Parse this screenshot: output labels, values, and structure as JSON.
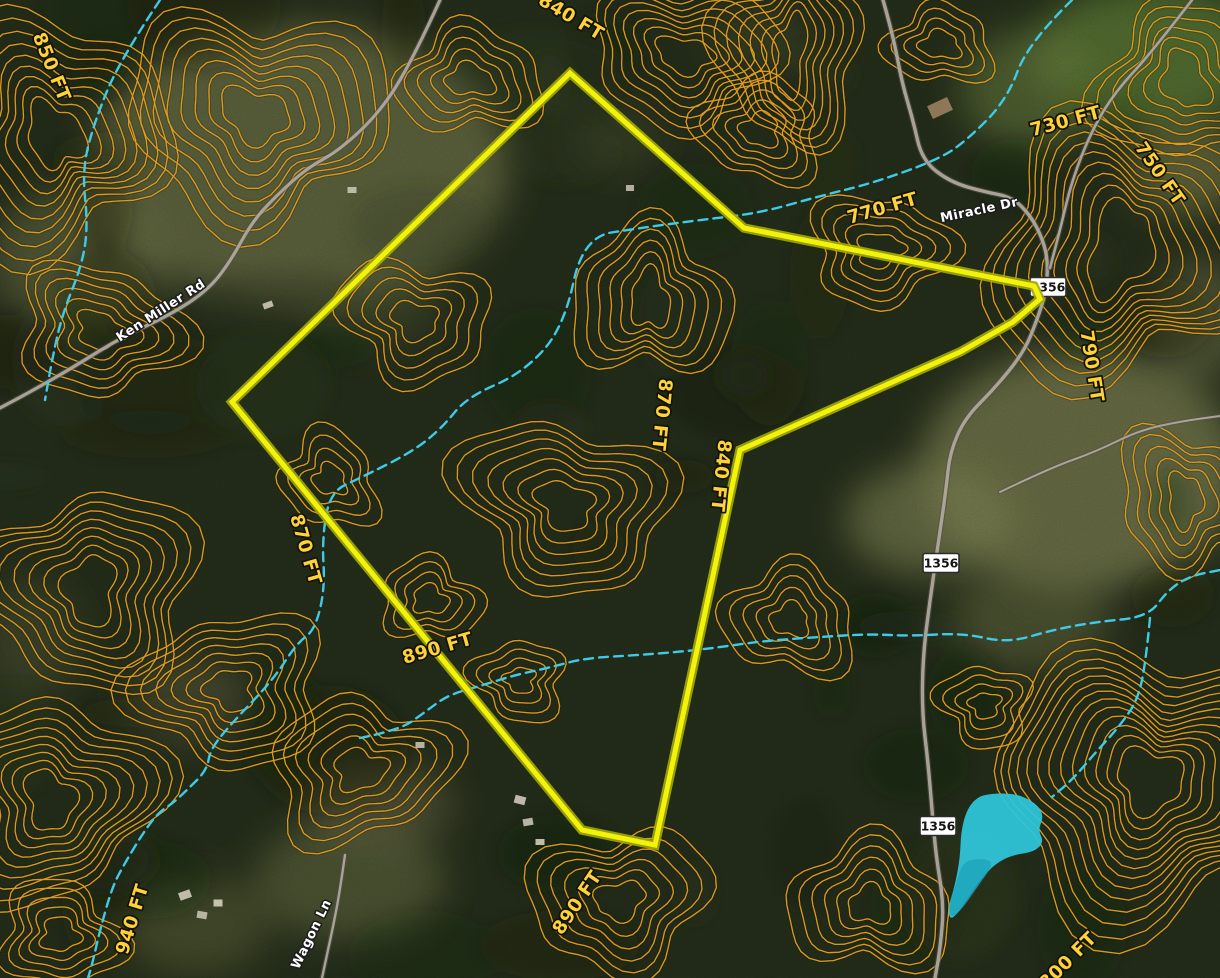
{
  "map": {
    "colors": {
      "forest_base": "#27311c",
      "contour": "#e29e1c",
      "boundary_core": "#f2f20a",
      "boundary_casing": "#a3a80a",
      "stream": "#3fcbe8",
      "pond_fill": "#2ec4d8",
      "pond_shade": "#1ea4bd",
      "road_core": "#b3ada0",
      "road_casing": "#55504a",
      "elevation_text": "#ffd235",
      "road_text": "#ffffff",
      "shield_bg": "#ffffff",
      "shield_text": "#151515"
    },
    "boundary": {
      "points": [
        [
          570,
          73
        ],
        [
          744,
          228
        ],
        [
          1034,
          286
        ],
        [
          1040,
          299
        ],
        [
          1013,
          322
        ],
        [
          960,
          352
        ],
        [
          740,
          450
        ],
        [
          655,
          845
        ],
        [
          582,
          830
        ],
        [
          232,
          402
        ]
      ]
    },
    "elevation_labels": [
      {
        "text": "850 FT",
        "x": 46,
        "y": 69,
        "rot": 68
      },
      {
        "text": "840 FT",
        "x": 568,
        "y": 22,
        "rot": 31
      },
      {
        "text": "730 FT",
        "x": 1067,
        "y": 127,
        "rot": -15
      },
      {
        "text": "750 FT",
        "x": 1155,
        "y": 177,
        "rot": 55
      },
      {
        "text": "770 FT",
        "x": 884,
        "y": 214,
        "rot": -16
      },
      {
        "text": "790 FT",
        "x": 1086,
        "y": 367,
        "rot": 81
      },
      {
        "text": "870 FT",
        "x": 656,
        "y": 414,
        "rot": 96
      },
      {
        "text": "840 FT",
        "x": 715,
        "y": 475,
        "rot": 96
      },
      {
        "text": "870 FT",
        "x": 300,
        "y": 551,
        "rot": 74
      },
      {
        "text": "890 FT",
        "x": 439,
        "y": 654,
        "rot": -16
      },
      {
        "text": "890 FT",
        "x": 582,
        "y": 906,
        "rot": -56
      },
      {
        "text": "940 FT",
        "x": 138,
        "y": 921,
        "rot": -73
      },
      {
        "text": "800 FT",
        "x": 1072,
        "y": 965,
        "rot": -45
      }
    ],
    "road_labels": [
      {
        "text": "Ken Miller Rd",
        "x": 163,
        "y": 314,
        "rot": -33
      },
      {
        "text": "Miracle Dr",
        "x": 980,
        "y": 214,
        "rot": -12
      },
      {
        "text": "Wagon Ln",
        "x": 315,
        "y": 936,
        "rot": -64
      }
    ],
    "route_shields": [
      {
        "text": "1356",
        "x": 1048,
        "y": 287
      },
      {
        "text": "1356",
        "x": 941,
        "y": 563
      },
      {
        "text": "1356",
        "x": 938,
        "y": 826
      }
    ],
    "roads": [
      {
        "id": "ken-miller-rd",
        "w": 3.2,
        "points": [
          [
            440,
            0
          ],
          [
            415,
            55
          ],
          [
            382,
            110
          ],
          [
            340,
            150
          ],
          [
            307,
            168
          ],
          [
            276,
            196
          ],
          [
            252,
            222
          ],
          [
            230,
            262
          ],
          [
            208,
            290
          ],
          [
            170,
            315
          ],
          [
            120,
            338
          ],
          [
            72,
            368
          ],
          [
            30,
            392
          ],
          [
            0,
            408
          ]
        ]
      },
      {
        "id": "miracle-dr-1356",
        "w": 3.4,
        "points": [
          [
            883,
            0
          ],
          [
            893,
            35
          ],
          [
            902,
            83
          ],
          [
            913,
            120
          ],
          [
            922,
            160
          ],
          [
            950,
            182
          ],
          [
            985,
            192
          ],
          [
            1012,
            197
          ],
          [
            1031,
            216
          ],
          [
            1043,
            240
          ],
          [
            1048,
            262
          ],
          [
            1046,
            292
          ],
          [
            1037,
            320
          ],
          [
            1024,
            352
          ],
          [
            995,
            388
          ],
          [
            965,
            418
          ],
          [
            950,
            452
          ],
          [
            946,
            490
          ],
          [
            938,
            545
          ],
          [
            930,
            600
          ],
          [
            923,
            655
          ],
          [
            922,
            712
          ],
          [
            928,
            762
          ],
          [
            932,
            810
          ],
          [
            936,
            856
          ],
          [
            944,
            905
          ],
          [
            940,
            950
          ],
          [
            935,
            978
          ]
        ]
      },
      {
        "id": "wagon-ln",
        "w": 2.4,
        "points": [
          [
            345,
            855
          ],
          [
            340,
            890
          ],
          [
            334,
            922
          ],
          [
            328,
            950
          ],
          [
            322,
            978
          ]
        ]
      },
      {
        "id": "farm-track",
        "w": 2.0,
        "points": [
          [
            1000,
            492
          ],
          [
            1050,
            468
          ],
          [
            1095,
            452
          ],
          [
            1140,
            430
          ],
          [
            1183,
            421
          ],
          [
            1220,
            416
          ]
        ]
      },
      {
        "id": "top-right-road",
        "w": 2.6,
        "points": [
          [
            1192,
            0
          ],
          [
            1152,
            52
          ],
          [
            1115,
            92
          ],
          [
            1092,
            130
          ],
          [
            1072,
            180
          ],
          [
            1060,
            230
          ],
          [
            1050,
            268
          ]
        ]
      }
    ],
    "streams": [
      [
        [
          1072,
          0
        ],
        [
          1028,
          43
        ],
        [
          1007,
          100
        ],
        [
          965,
          142
        ],
        [
          937,
          160
        ],
        [
          873,
          183
        ],
        [
          820,
          196
        ],
        [
          760,
          213
        ],
        [
          700,
          220
        ],
        [
          640,
          228
        ],
        [
          583,
          237
        ],
        [
          564,
          327
        ],
        [
          523,
          373
        ],
        [
          467,
          397
        ],
        [
          442,
          428
        ],
        [
          412,
          452
        ],
        [
          360,
          478
        ],
        [
          330,
          492
        ],
        [
          322,
          540
        ],
        [
          325,
          588
        ],
        [
          315,
          630
        ],
        [
          297,
          643
        ],
        [
          273,
          680
        ],
        [
          230,
          725
        ],
        [
          210,
          750
        ],
        [
          207,
          770
        ],
        [
          187,
          790
        ],
        [
          173,
          803
        ],
        [
          158,
          813
        ],
        [
          143,
          833
        ],
        [
          122,
          868
        ],
        [
          112,
          888
        ],
        [
          100,
          930
        ],
        [
          92,
          965
        ],
        [
          88,
          978
        ]
      ],
      [
        [
          360,
          738
        ],
        [
          400,
          730
        ],
        [
          425,
          712
        ],
        [
          448,
          695
        ],
        [
          480,
          686
        ],
        [
          515,
          675
        ],
        [
          548,
          668
        ],
        [
          585,
          658
        ],
        [
          640,
          655
        ],
        [
          700,
          650
        ],
        [
          762,
          641
        ],
        [
          820,
          637
        ],
        [
          868,
          634
        ],
        [
          912,
          636
        ],
        [
          962,
          633
        ],
        [
          1008,
          643
        ],
        [
          1052,
          630
        ],
        [
          1095,
          622
        ],
        [
          1148,
          617
        ],
        [
          1168,
          590
        ],
        [
          1190,
          576
        ],
        [
          1220,
          570
        ]
      ],
      [
        [
          160,
          0
        ],
        [
          120,
          60
        ],
        [
          95,
          120
        ],
        [
          82,
          170
        ],
        [
          88,
          225
        ],
        [
          82,
          265
        ],
        [
          62,
          315
        ],
        [
          52,
          360
        ],
        [
          45,
          400
        ]
      ],
      [
        [
          1150,
          618
        ],
        [
          1146,
          660
        ],
        [
          1138,
          700
        ],
        [
          1118,
          728
        ],
        [
          1096,
          752
        ],
        [
          1072,
          780
        ],
        [
          1052,
          797
        ]
      ]
    ],
    "pond": {
      "points": [
        [
          985,
          794
        ],
        [
          1015,
          793
        ],
        [
          1036,
          803
        ],
        [
          1044,
          816
        ],
        [
          1038,
          830
        ],
        [
          1044,
          842
        ],
        [
          1034,
          852
        ],
        [
          1012,
          855
        ],
        [
          995,
          864
        ],
        [
          980,
          880
        ],
        [
          968,
          898
        ],
        [
          958,
          913
        ],
        [
          950,
          920
        ],
        [
          948,
          908
        ],
        [
          955,
          885
        ],
        [
          960,
          858
        ],
        [
          961,
          832
        ],
        [
          966,
          812
        ],
        [
          974,
          800
        ]
      ],
      "shade_points": [
        [
          995,
          862
        ],
        [
          978,
          886
        ],
        [
          963,
          908
        ],
        [
          951,
          919
        ],
        [
          949,
          905
        ],
        [
          957,
          880
        ],
        [
          963,
          862
        ],
        [
          980,
          858
        ]
      ]
    },
    "buildings": [
      [
        185,
        895,
        12,
        8,
        -20,
        "#cfcabb"
      ],
      [
        202,
        915,
        10,
        7,
        10,
        "#c6c1b2"
      ],
      [
        218,
        903,
        9,
        7,
        0,
        "#d5d0c0"
      ],
      [
        520,
        800,
        11,
        8,
        15,
        "#cfcabb"
      ],
      [
        528,
        822,
        10,
        7,
        -10,
        "#c9c4b5"
      ],
      [
        540,
        842,
        9,
        6,
        0,
        "#d2cdbd"
      ],
      [
        940,
        108,
        22,
        14,
        -25,
        "#9a7f5e"
      ],
      [
        420,
        745,
        9,
        6,
        0,
        "#c6c1b2"
      ],
      [
        268,
        305,
        10,
        6,
        -20,
        "#cdc8b8"
      ],
      [
        352,
        190,
        9,
        6,
        0,
        "#c9c4b4"
      ],
      [
        630,
        188,
        8,
        6,
        0,
        "#c2bdae"
      ]
    ],
    "fields": [
      [
        300,
        165,
        210,
        140,
        "#6e7347",
        0.8
      ],
      [
        80,
        260,
        90,
        70,
        "#747a4c",
        0.55
      ],
      [
        1150,
        55,
        120,
        70,
        "#5e7c37",
        0.85
      ],
      [
        1030,
        90,
        70,
        60,
        "#6c8440",
        0.6
      ],
      [
        1190,
        170,
        60,
        45,
        "#87894f",
        0.6
      ],
      [
        1080,
        470,
        160,
        120,
        "#7d8153",
        0.8
      ],
      [
        930,
        520,
        85,
        55,
        "#868a57",
        0.65
      ],
      [
        1030,
        620,
        80,
        50,
        "#737748",
        0.5
      ],
      [
        1200,
        320,
        50,
        60,
        "#7f8251",
        0.5
      ],
      [
        350,
        880,
        95,
        60,
        "#6b7045",
        0.6
      ],
      [
        195,
        925,
        75,
        50,
        "#60663d",
        0.55
      ],
      [
        190,
        700,
        60,
        40,
        "#6d6a48",
        0.5
      ],
      [
        380,
        805,
        75,
        40,
        "#766f4b",
        0.5
      ],
      [
        30,
        640,
        50,
        60,
        "#5f6540",
        0.4
      ],
      [
        370,
        300,
        70,
        50,
        "#5a6138",
        0.35
      ],
      [
        617,
        140,
        45,
        30,
        "#5c653c",
        0.35
      ],
      [
        760,
        40,
        50,
        30,
        "#62693f",
        0.3
      ]
    ],
    "contour_hills": [
      [
        55,
        135,
        26,
        34,
        9,
        11,
        -20
      ],
      [
        255,
        115,
        34,
        26,
        8,
        13,
        15
      ],
      [
        470,
        80,
        24,
        16,
        5,
        11,
        0
      ],
      [
        685,
        55,
        28,
        18,
        7,
        10,
        5
      ],
      [
        940,
        45,
        20,
        14,
        4,
        10,
        0
      ],
      [
        1120,
        250,
        30,
        48,
        10,
        11,
        25
      ],
      [
        1185,
        80,
        22,
        30,
        6,
        12,
        -15
      ],
      [
        100,
        330,
        24,
        18,
        6,
        11,
        10
      ],
      [
        90,
        590,
        26,
        34,
        8,
        11,
        15
      ],
      [
        50,
        800,
        24,
        30,
        9,
        10,
        -10
      ],
      [
        230,
        690,
        24,
        20,
        7,
        11,
        0
      ],
      [
        360,
        770,
        26,
        20,
        6,
        12,
        -15
      ],
      [
        565,
        505,
        30,
        22,
        7,
        12,
        20
      ],
      [
        430,
        600,
        18,
        14,
        4,
        10,
        0
      ],
      [
        415,
        320,
        24,
        18,
        5,
        12,
        10
      ],
      [
        650,
        300,
        20,
        28,
        6,
        11,
        0
      ],
      [
        1150,
        780,
        34,
        30,
        13,
        10,
        10
      ],
      [
        870,
        905,
        22,
        18,
        6,
        11,
        0
      ],
      [
        620,
        900,
        26,
        18,
        6,
        12,
        -20
      ],
      [
        790,
        620,
        20,
        16,
        5,
        11,
        0
      ],
      [
        1185,
        500,
        18,
        26,
        5,
        12,
        0
      ],
      [
        760,
        130,
        20,
        16,
        5,
        10,
        0
      ],
      [
        880,
        250,
        24,
        16,
        5,
        11,
        -10
      ],
      [
        790,
        55,
        16,
        40,
        7,
        9,
        8
      ],
      [
        330,
        480,
        18,
        14,
        4,
        11,
        30
      ],
      [
        520,
        680,
        16,
        12,
        4,
        10,
        0
      ],
      [
        60,
        935,
        20,
        16,
        5,
        10,
        0
      ],
      [
        985,
        705,
        16,
        12,
        4,
        10,
        0
      ]
    ]
  }
}
